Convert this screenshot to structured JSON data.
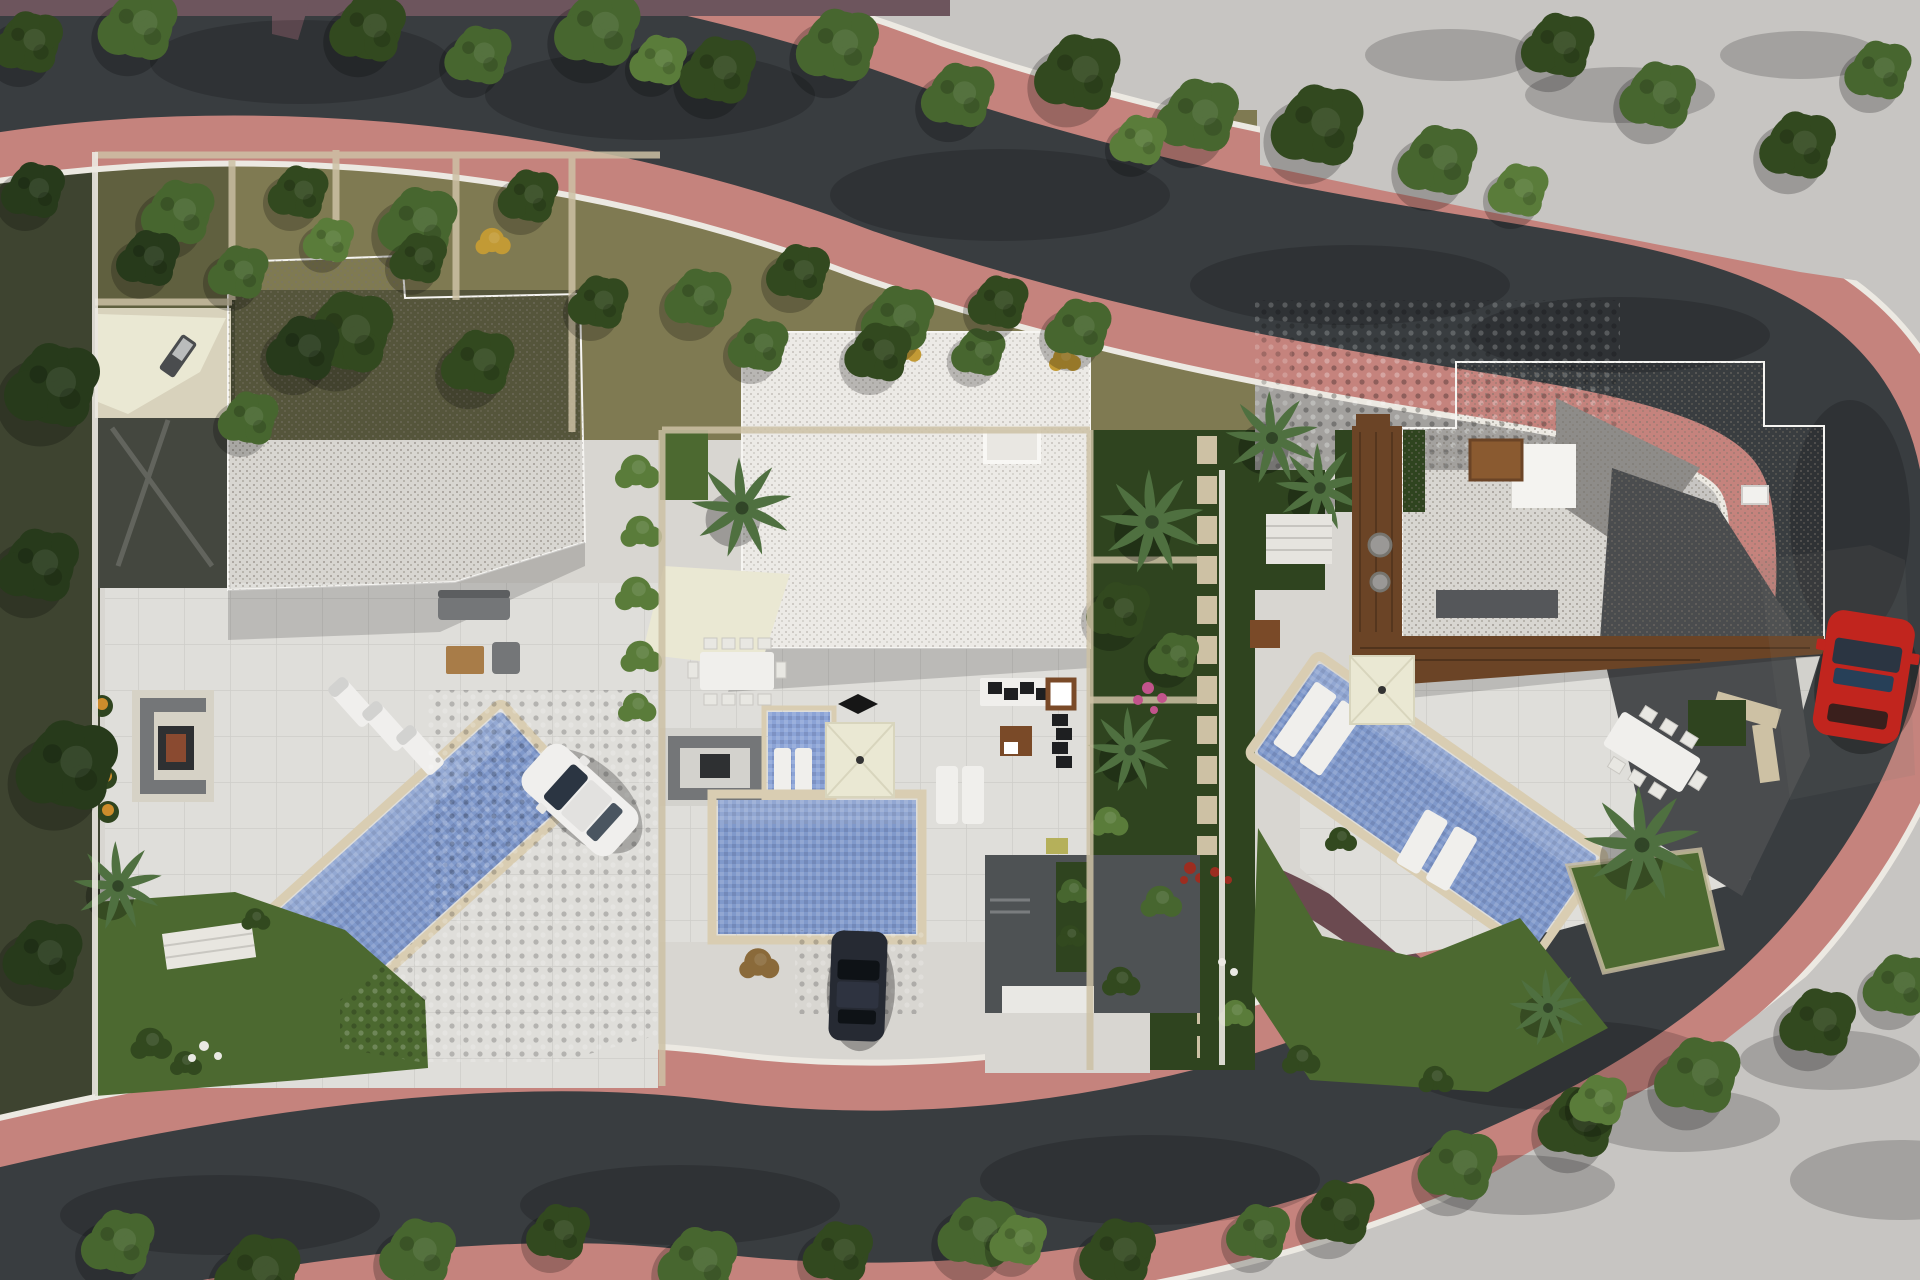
{
  "scene": {
    "title": "Aerial 3D site-plan rendering of three modern villas along a curving street",
    "colors": {
      "concrete_light": "#c7c5c2",
      "asphalt": "#393d40",
      "sidewalk_pink": "#c5837d",
      "sidewalk_mauve": "#6d555d",
      "wall_white": "#ece9e2",
      "base_paving": "#d8d6d1",
      "neighbor_dark": "#3e4430",
      "olive_garden": "#7f7a52",
      "olive_dark": "#60603f",
      "lawn_green": "#4c6930",
      "lawn_dark": "#2f441f",
      "tree_mid": "#47662f",
      "tree_dark": "#32491f",
      "tree_verydark": "#273a1b",
      "tree_light": "#5a7c3a",
      "palm_green": "#4f7040",
      "roof_white": "#eceae6",
      "roof_bright": "#f4f3f0",
      "terrace_white": "#dfdeda",
      "cobble_gray": "#a3a19e",
      "charcoal_court": "#4e5254",
      "charcoal_drive": "#4a4c4e",
      "dark_drive": "#44473f",
      "mid_gray_drive": "#8e8c89",
      "pool_water": "#8099cb",
      "spa_water": "#8ba3d6",
      "coping_cream": "#d9cdb2",
      "sail_cream": "#eae8d3",
      "wood_deck": "#6b4426",
      "wood_table": "#a87c48",
      "car_white": "#f0efed",
      "car_red": "#c1251e",
      "car_navy": "#262a33",
      "glass_dark": "#2b3542",
      "flower_orange": "#cd8c2c",
      "flower_pink": "#c2548c",
      "flower_red": "#9c2d20",
      "flower_yellow": "#c29a35",
      "stone_path": "#cdc1a4"
    },
    "environment": {
      "roads": "one curving asphalt street entering top-left, sweeping along the top, hairpinning down the right side and exiting bottom-left",
      "sidewalks": "terracotta-pink footpaths lining the inner side of the street, mauve strip on the far upper side",
      "trees": "dense green street trees along both road edges and dark trees in the left neighbouring garden",
      "corners": "bare light concrete ground at the top-right and bottom-right corners with tree shadows"
    },
    "villas": [
      {
        "id": "villa-1",
        "position": "left",
        "features": [
          "white gravel flat roof",
          "shade-sail side patio with lounger",
          "shaded entry drive with tyre marks",
          "large white terrace",
          "diagonal swimming pool",
          "three sun loungers",
          "corner sofa with wooden coffee table",
          "sunken lounge with fire table",
          "orange flower bed",
          "lawn with palm and shrubs",
          "white garden steps",
          "cobbled driveway",
          "parked white car"
        ]
      },
      {
        "id": "villa-2",
        "position": "center",
        "features": [
          "white gravel flat roof with chimney",
          "cream shade sail",
          "outdoor dining table with eight chairs",
          "sunken lounge with fire table",
          "raised mosaic spa with two loungers",
          "square cream parasol",
          "main swimming pool",
          "two sun loungers",
          "black sectional lounge",
          "wooden side table",
          "sunken rear courtyard with planters and garage door",
          "cobbled drive",
          "parked dark car"
        ]
      },
      {
        "id": "villa-3",
        "position": "right",
        "features": [
          "stepped white gravel roof with skylight and roof vent",
          "timber pergola deck",
          "angled swimming pool with tanning ledge",
          "square cream parasol",
          "angled outdoor dining table with chairs",
          "lawn with palms and two loungers",
          "entry courtyard with white steps",
          "stone stepping path",
          "sloped charcoal driveway",
          "parked red car"
        ]
      }
    ],
    "vehicles": [
      {
        "id": "white-car",
        "location": "villa-1 driveway"
      },
      {
        "id": "dark-car",
        "location": "villa-2 driveway"
      },
      {
        "id": "red-car",
        "location": "street parking beside villa-3"
      }
    ]
  }
}
